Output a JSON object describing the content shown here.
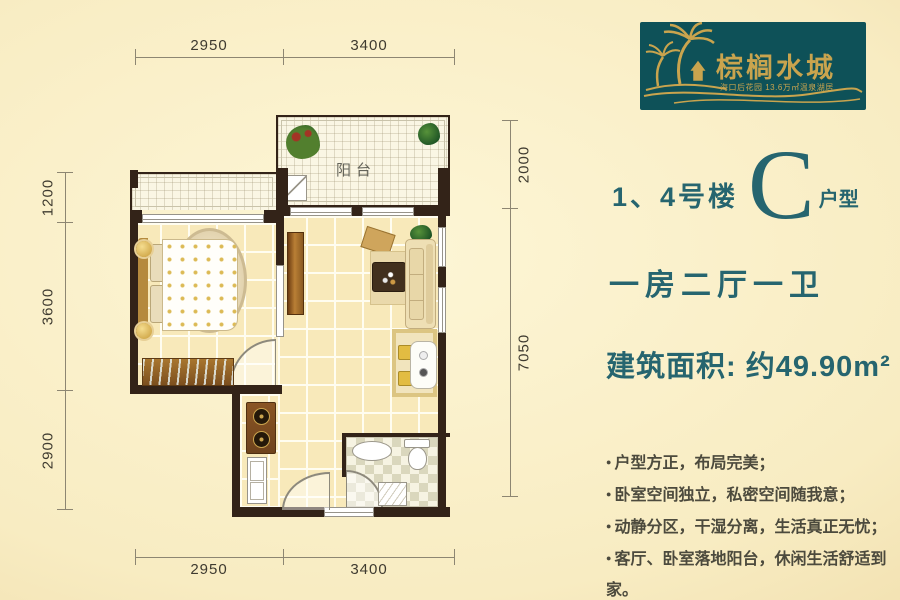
{
  "logo": {
    "title": "棕榈水城",
    "subtitle": "海口后花园 13.6万㎡温泉湖居"
  },
  "unit": {
    "prefix": "1、4号楼",
    "letter": "C",
    "suffix": "户型"
  },
  "layout_text": "一房二厅一卫",
  "area_text": "建筑面积: 约49.90m²",
  "bullet": "●",
  "features": [
    "户型方正，布局完美；",
    "卧室空间独立，私密空间随我意；",
    "动静分区，干湿分离，生活真正无忧；",
    "客厅、卧室落地阳台，休闲生活舒适到家。"
  ],
  "plan": {
    "balcony_label": "阳台"
  },
  "dimensions": {
    "top": [
      "2950",
      "3400"
    ],
    "bottom": [
      "2950",
      "3400"
    ],
    "left": [
      "1200",
      "3600",
      "2900"
    ],
    "right": [
      "2000",
      "7050"
    ]
  },
  "colors": {
    "accent_teal": "#26656f",
    "logo_bg": "#0e5158",
    "logo_gold": "#c9a44e",
    "wall": "#332318",
    "floor_tile": "#f8e9ba",
    "background": "#f8ecc2",
    "feature_text": "#4c4a3d",
    "dimension_text": "#3f3b30"
  }
}
